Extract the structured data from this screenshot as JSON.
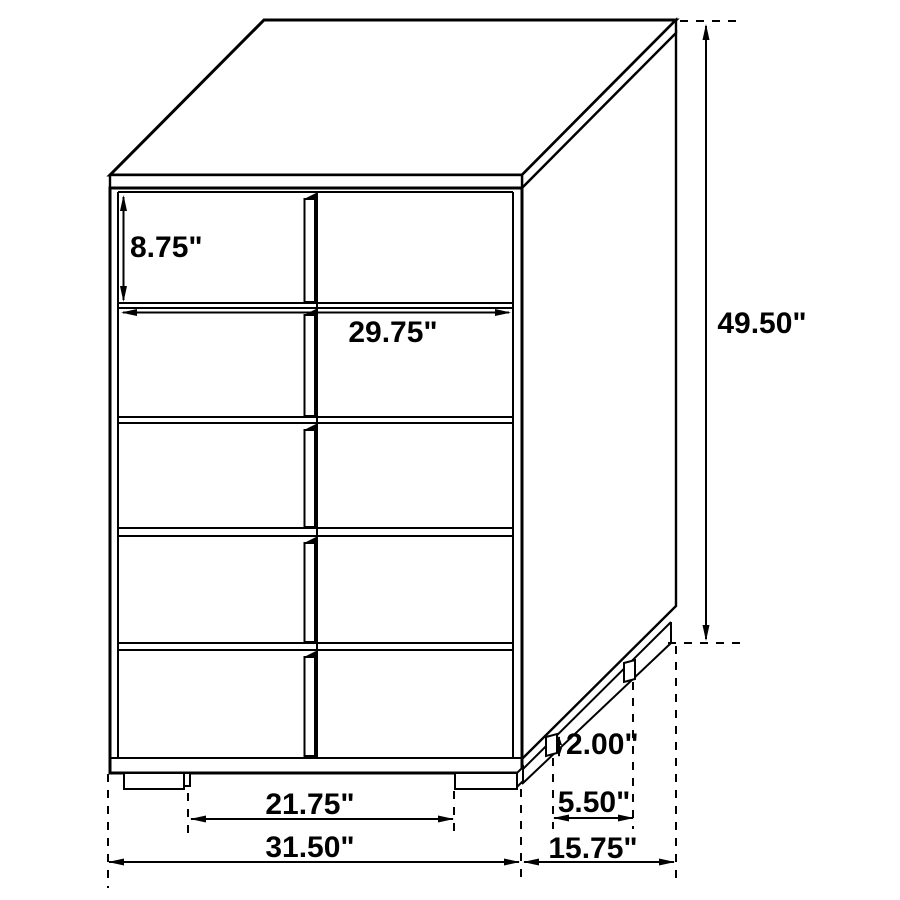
{
  "colors": {
    "line": "#000000",
    "background": "#ffffff",
    "text": "#000000"
  },
  "drawing": {
    "subject": "chest of drawers",
    "drawer_rows": 5,
    "view": "three-quarter line drawing"
  },
  "dimensions": {
    "top_drawer_height": "8.75\"",
    "drawer_width": "29.75\"",
    "overall_height": "49.50\"",
    "foot_height": "2.00\"",
    "side_foot_spacing": "5.50\"",
    "front_foot_spacing": "21.75\"",
    "overall_width": "31.50\"",
    "overall_depth": "15.75\""
  }
}
